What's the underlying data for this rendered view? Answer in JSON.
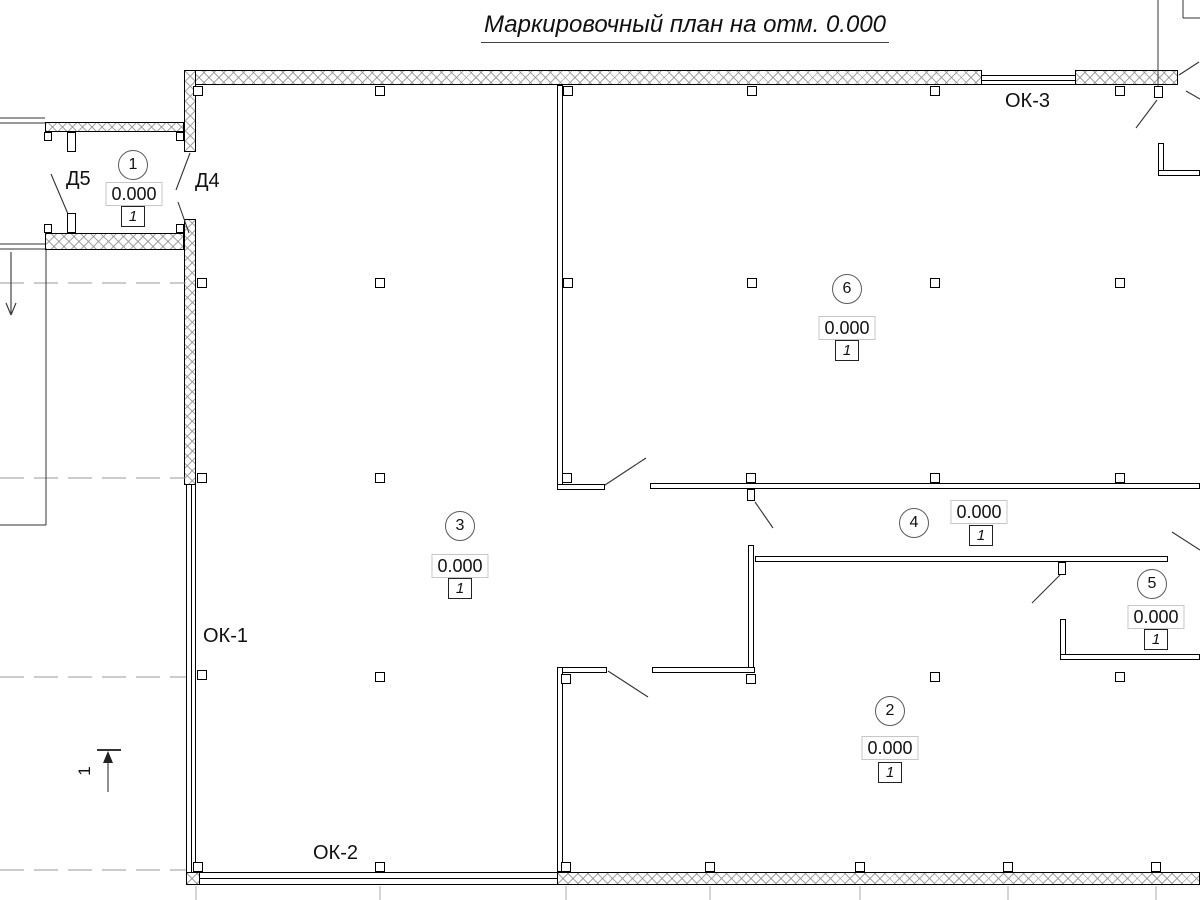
{
  "title": "Маркировочный план на отм. 0.000",
  "rooms": [
    {
      "number": "1",
      "elevation": "0.000",
      "floor_type": "1"
    },
    {
      "number": "2",
      "elevation": "0.000",
      "floor_type": "1"
    },
    {
      "number": "3",
      "elevation": "0.000",
      "floor_type": "1"
    },
    {
      "number": "4",
      "elevation": "0.000",
      "floor_type": "1"
    },
    {
      "number": "5",
      "elevation": "0.000",
      "floor_type": "1"
    },
    {
      "number": "6",
      "elevation": "0.000",
      "floor_type": "1"
    }
  ],
  "door_labels": {
    "d5": "Д5",
    "d4": "Д4"
  },
  "window_labels": {
    "ok1": "ОК-1",
    "ok2": "ОК-2",
    "ok3": "ОК-3"
  },
  "section_mark": {
    "label": "1"
  },
  "colors": {
    "background": "#ffffff",
    "line": "#1a1a1a",
    "wall_hatch": "#bdbdbd",
    "dashed_level_line": "#999999",
    "extension_line": "#ababab",
    "annotation_box_border": "#c6c6c6"
  }
}
